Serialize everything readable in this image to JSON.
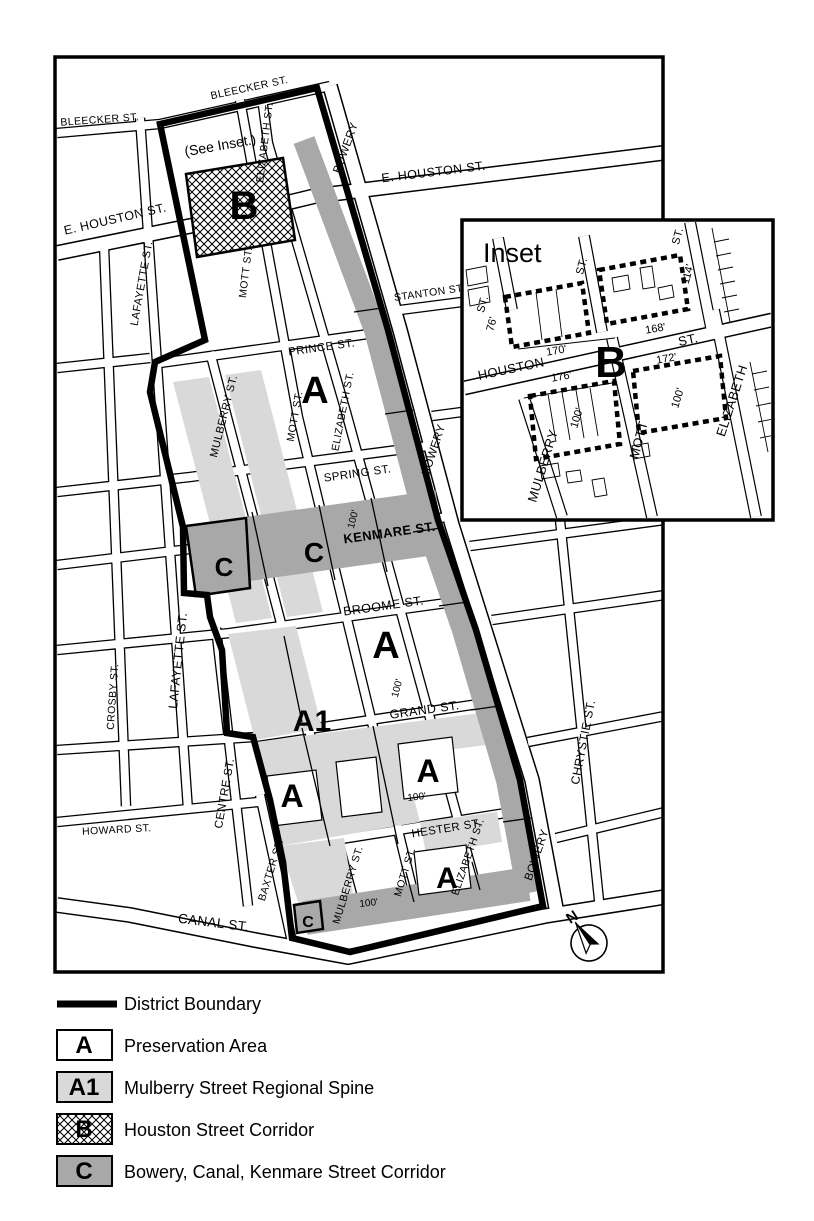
{
  "streets": {
    "bleecker": "BLEECKER ST.",
    "e_houston": "E. HOUSTON ST.",
    "stanton": "STANTON ST.",
    "prince": "PRINCE ST.",
    "spring": "SPRING ST.",
    "kenmare": "KENMARE ST.",
    "broome": "BROOME ST.",
    "grand": "GRAND ST.",
    "hester": "HESTER ST.",
    "canal": "CANAL ST.",
    "howard": "HOWARD ST.",
    "bowery": "BOWERY",
    "chrystie": "CHRYSTIE ST.",
    "lafayette": "LAFAYETTE ST.",
    "crosby": "CROSBY ST.",
    "centre": "CENTRE ST.",
    "baxter": "BAXTER ST.",
    "mulberry": "MULBERRY ST.",
    "mott": "MOTT ST.",
    "elizabeth": "ELIZABETH ST."
  },
  "areas": {
    "preservation": "A",
    "spine": "A1",
    "houston_corridor": "B",
    "corridor": "C"
  },
  "annotations": {
    "see_inset": "(See Inset.)",
    "north": "N",
    "dim_100": "100'"
  },
  "inset": {
    "title": "Inset",
    "area": "B",
    "houston": "HOUSTON",
    "st": "ST.",
    "mulberry": "MULBERRY",
    "mott": "MOTT",
    "elizabeth": "ELIZABETH",
    "dim_76": "76'",
    "dim_170": "170'",
    "dim_168": "168'",
    "dim_114": "114'",
    "dim_176": "176'",
    "dim_172": "172'",
    "dim_100": "100'"
  },
  "legend": {
    "items": [
      {
        "symbol": "",
        "label": "District Boundary"
      },
      {
        "symbol": "A",
        "label": "Preservation Area"
      },
      {
        "symbol": "A1",
        "label": "Mulberry Street Regional Spine"
      },
      {
        "symbol": "B",
        "label": "Houston Street Corridor"
      },
      {
        "symbol": "C",
        "label": "Bowery, Canal, Kenmare Street Corridor"
      }
    ]
  },
  "colors": {
    "corridor_gray": "#a8a8a8",
    "spine_gray": "#d9d9d9",
    "boundary_black": "#000000"
  }
}
